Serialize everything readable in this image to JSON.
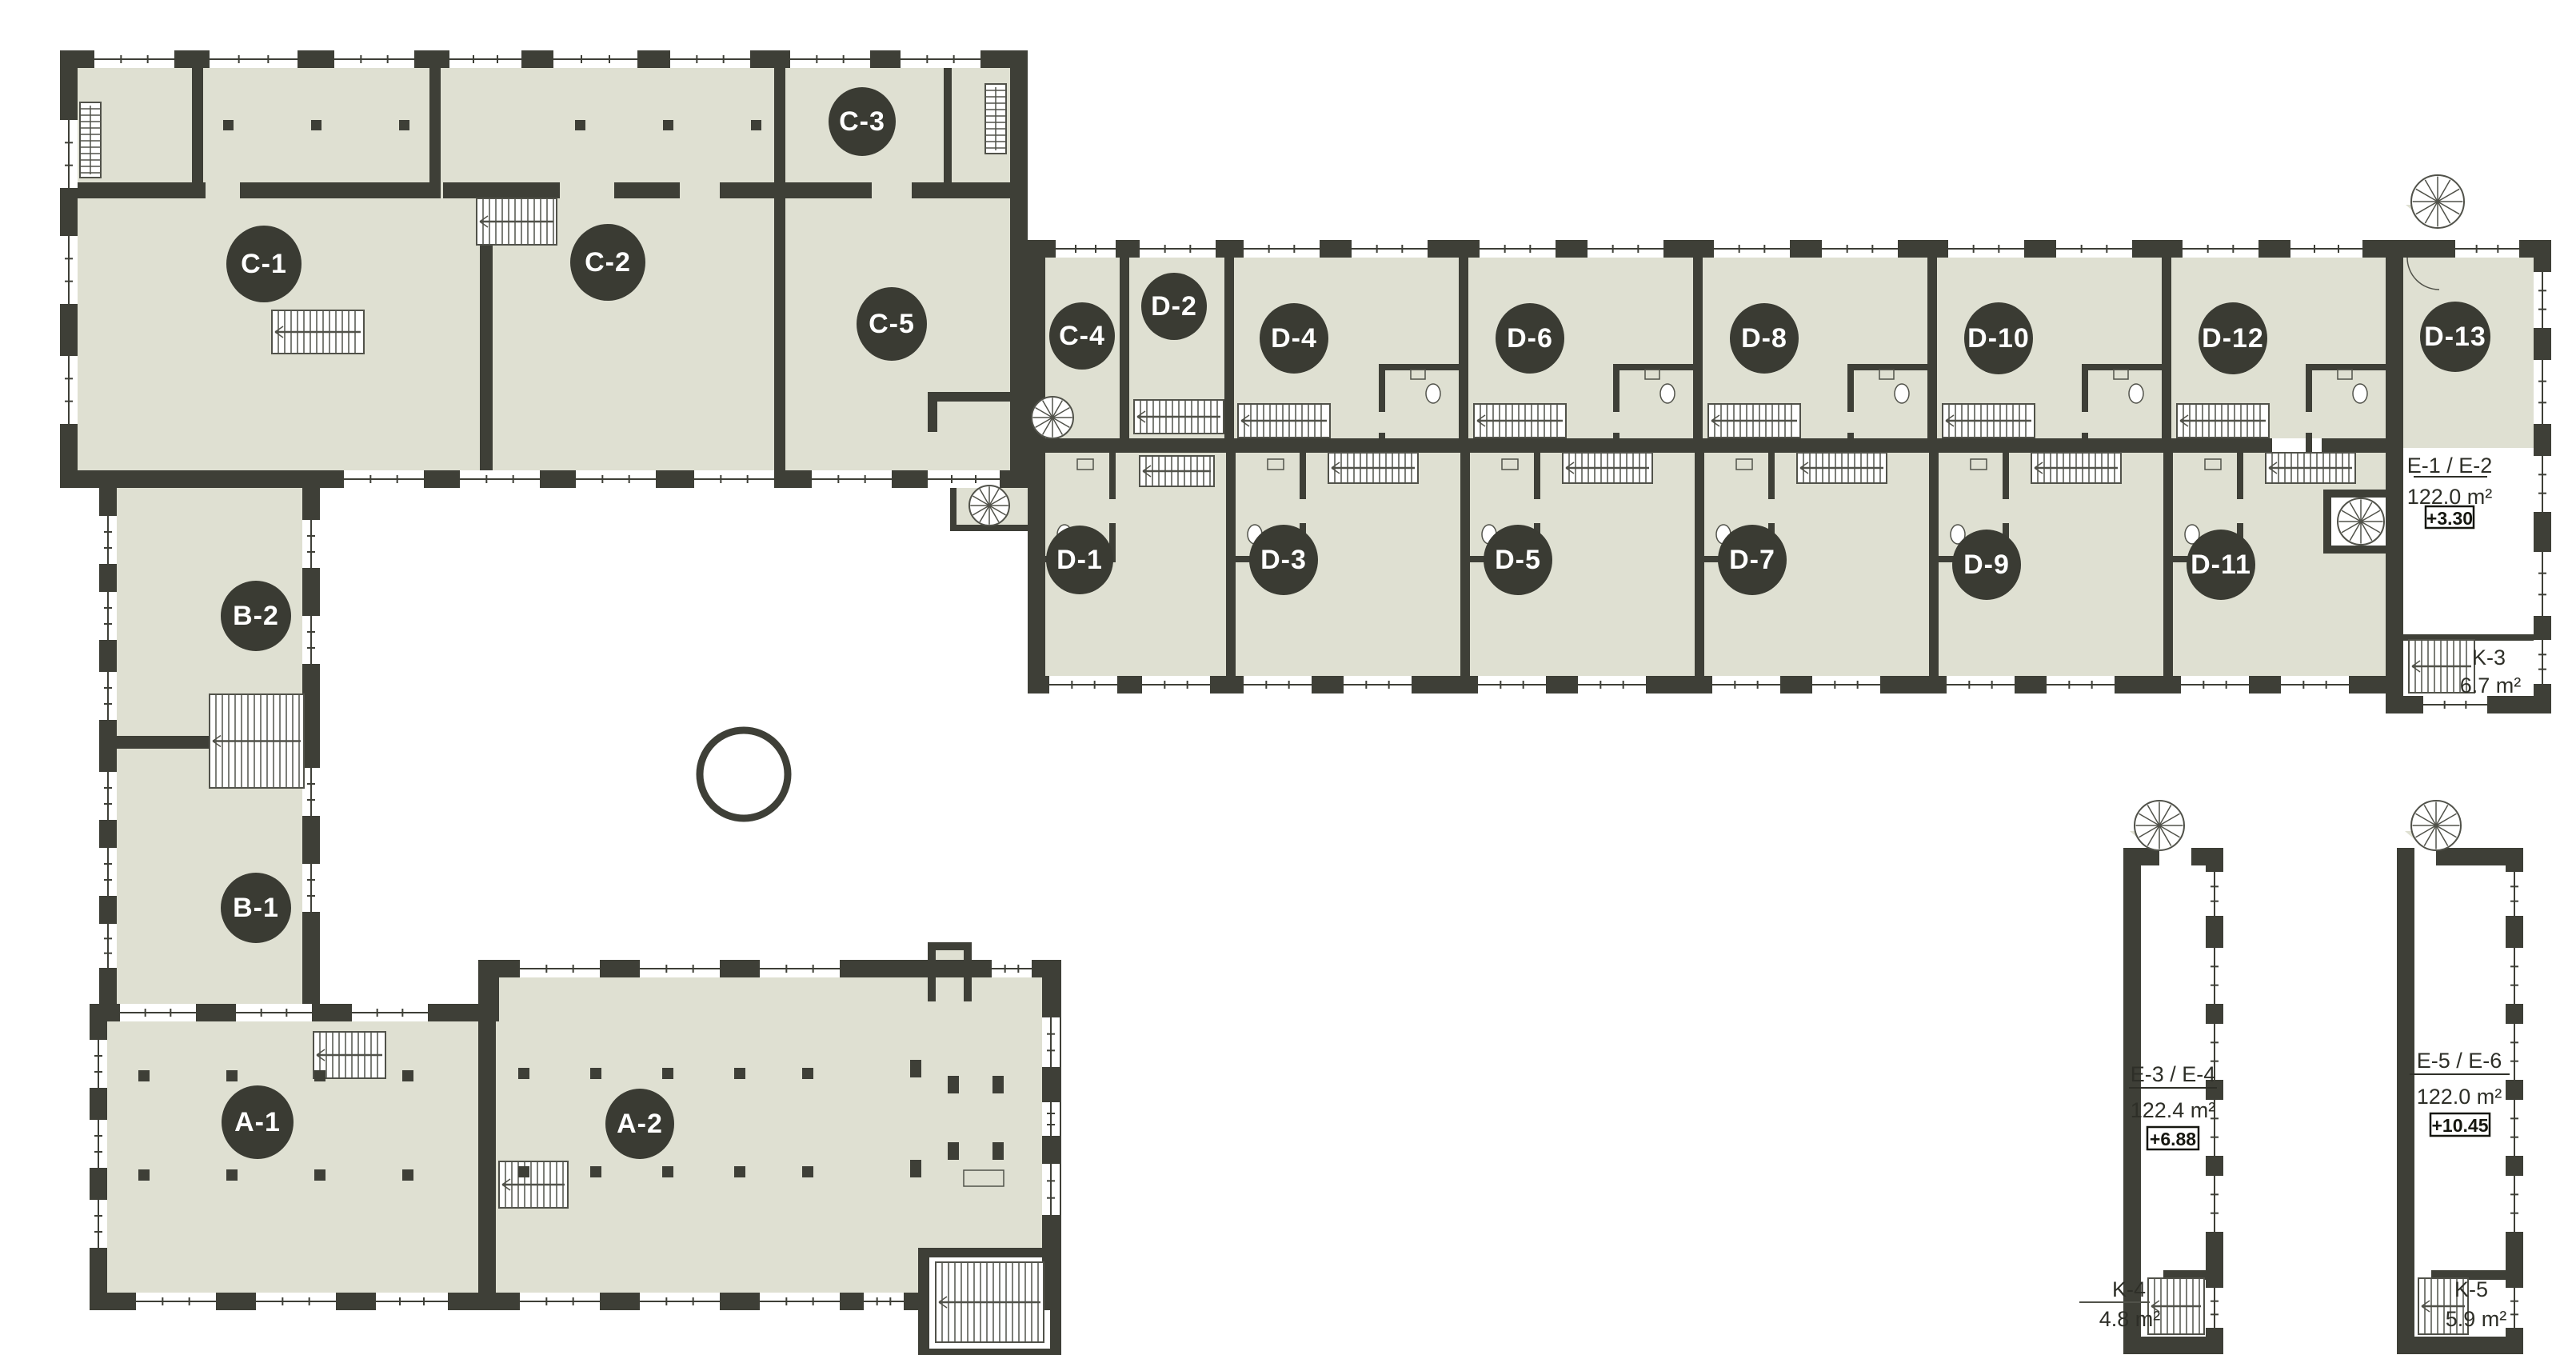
{
  "page": {
    "background": "#ffffff",
    "type": "architectural floor plan"
  },
  "colors": {
    "wall": "#3e3f37",
    "floor": "#dfe0d2",
    "bubble_fill": "#3a3b33",
    "bubble_text": "#ffffff",
    "annotation_text": "#2e2f28",
    "detail_line": "#51524a"
  },
  "units": [
    {
      "label": "C-1"
    },
    {
      "label": "C-2"
    },
    {
      "label": "C-3"
    },
    {
      "label": "C-5"
    },
    {
      "label": "C-4"
    },
    {
      "label": "D-2"
    },
    {
      "label": "D-4"
    },
    {
      "label": "D-6"
    },
    {
      "label": "D-8"
    },
    {
      "label": "D-10"
    },
    {
      "label": "D-12"
    },
    {
      "label": "D-13"
    },
    {
      "label": "D-1"
    },
    {
      "label": "D-3"
    },
    {
      "label": "D-5"
    },
    {
      "label": "D-7"
    },
    {
      "label": "D-9"
    },
    {
      "label": "D-11"
    },
    {
      "label": "B-2"
    },
    {
      "label": "B-1"
    },
    {
      "label": "A-1"
    },
    {
      "label": "A-2"
    }
  ],
  "annotations": {
    "e12": {
      "title": "E-1 / E-2",
      "area": "122.0 m²",
      "level": "+3.30"
    },
    "e34": {
      "title": "E-3 / E-4",
      "area": "122.4 m²",
      "level": "+6.88"
    },
    "e56": {
      "title": "E-5 / E-6",
      "area": "122.0 m²",
      "level": "+10.45"
    },
    "k3": {
      "label": "K-3",
      "area": "6.7 m²"
    },
    "k4": {
      "label": "K-4",
      "area": "4.8 m²"
    },
    "k5": {
      "label": "K-5",
      "area": "5.9 m²"
    }
  }
}
